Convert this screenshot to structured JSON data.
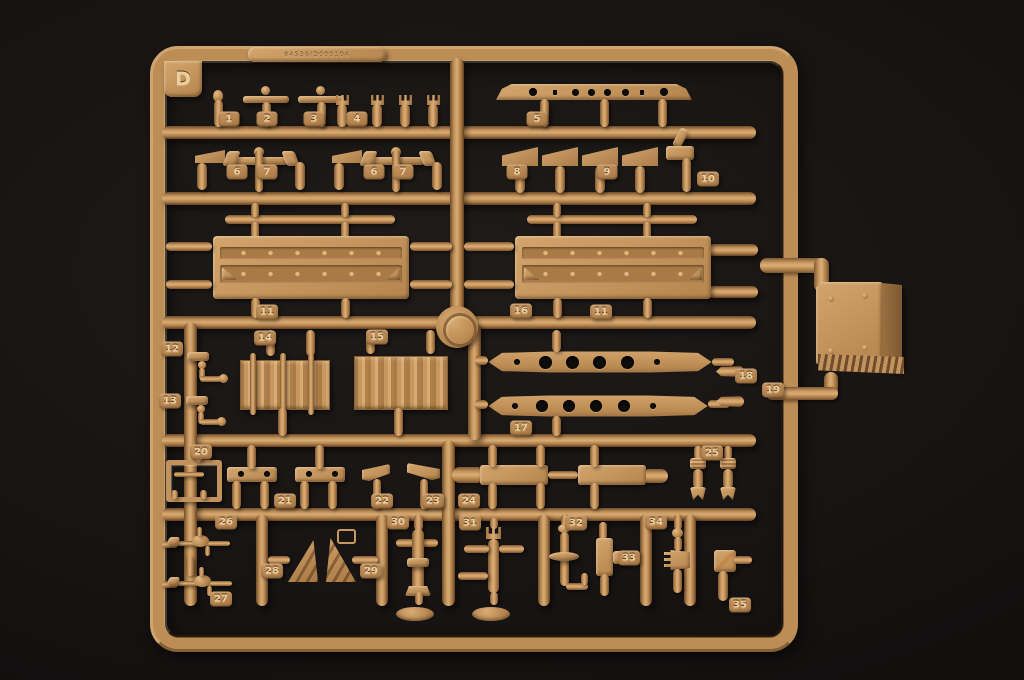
{
  "image": {
    "type": "photograph",
    "subject": "Injection-molded plastic model kit sprue (runner D) with numbered parts 1-35, tan plastic on black backdrop",
    "sprue_letter": "D",
    "molding_code": "84536/D000104",
    "plastic_color_hex": "#c2925c",
    "background_hex": "#131110"
  },
  "tabs": [
    {
      "label": "1",
      "x": 229,
      "y": 119
    },
    {
      "label": "2",
      "x": 267,
      "y": 119
    },
    {
      "label": "3",
      "x": 314,
      "y": 119
    },
    {
      "label": "4",
      "x": 357,
      "y": 119
    },
    {
      "label": "5",
      "x": 537,
      "y": 119
    },
    {
      "label": "6",
      "x": 237,
      "y": 172
    },
    {
      "label": "7",
      "x": 267,
      "y": 172
    },
    {
      "label": "6",
      "x": 374,
      "y": 172
    },
    {
      "label": "7",
      "x": 403,
      "y": 172
    },
    {
      "label": "8",
      "x": 517,
      "y": 172
    },
    {
      "label": "9",
      "x": 607,
      "y": 172
    },
    {
      "label": "10",
      "x": 708,
      "y": 179
    },
    {
      "label": "11",
      "x": 267,
      "y": 312
    },
    {
      "label": "11",
      "x": 601,
      "y": 312
    },
    {
      "label": "16",
      "x": 521,
      "y": 311
    },
    {
      "label": "12",
      "x": 172,
      "y": 349
    },
    {
      "label": "13",
      "x": 170,
      "y": 401
    },
    {
      "label": "14",
      "x": 265,
      "y": 338
    },
    {
      "label": "15",
      "x": 377,
      "y": 337
    },
    {
      "label": "18",
      "x": 746,
      "y": 376
    },
    {
      "label": "19",
      "x": 773,
      "y": 390
    },
    {
      "label": "17",
      "x": 521,
      "y": 428
    },
    {
      "label": "20",
      "x": 201,
      "y": 452
    },
    {
      "label": "25",
      "x": 712,
      "y": 453
    },
    {
      "label": "21",
      "x": 285,
      "y": 501
    },
    {
      "label": "22",
      "x": 382,
      "y": 501
    },
    {
      "label": "23",
      "x": 433,
      "y": 501
    },
    {
      "label": "24",
      "x": 469,
      "y": 501
    },
    {
      "label": "26",
      "x": 226,
      "y": 522
    },
    {
      "label": "30",
      "x": 398,
      "y": 522
    },
    {
      "label": "31",
      "x": 470,
      "y": 523
    },
    {
      "label": "32",
      "x": 576,
      "y": 523
    },
    {
      "label": "34",
      "x": 656,
      "y": 522
    },
    {
      "label": "33",
      "x": 629,
      "y": 558
    },
    {
      "label": "28",
      "x": 272,
      "y": 571
    },
    {
      "label": "29",
      "x": 371,
      "y": 571
    },
    {
      "label": "27",
      "x": 221,
      "y": 599
    },
    {
      "label": "35",
      "x": 740,
      "y": 605
    }
  ]
}
